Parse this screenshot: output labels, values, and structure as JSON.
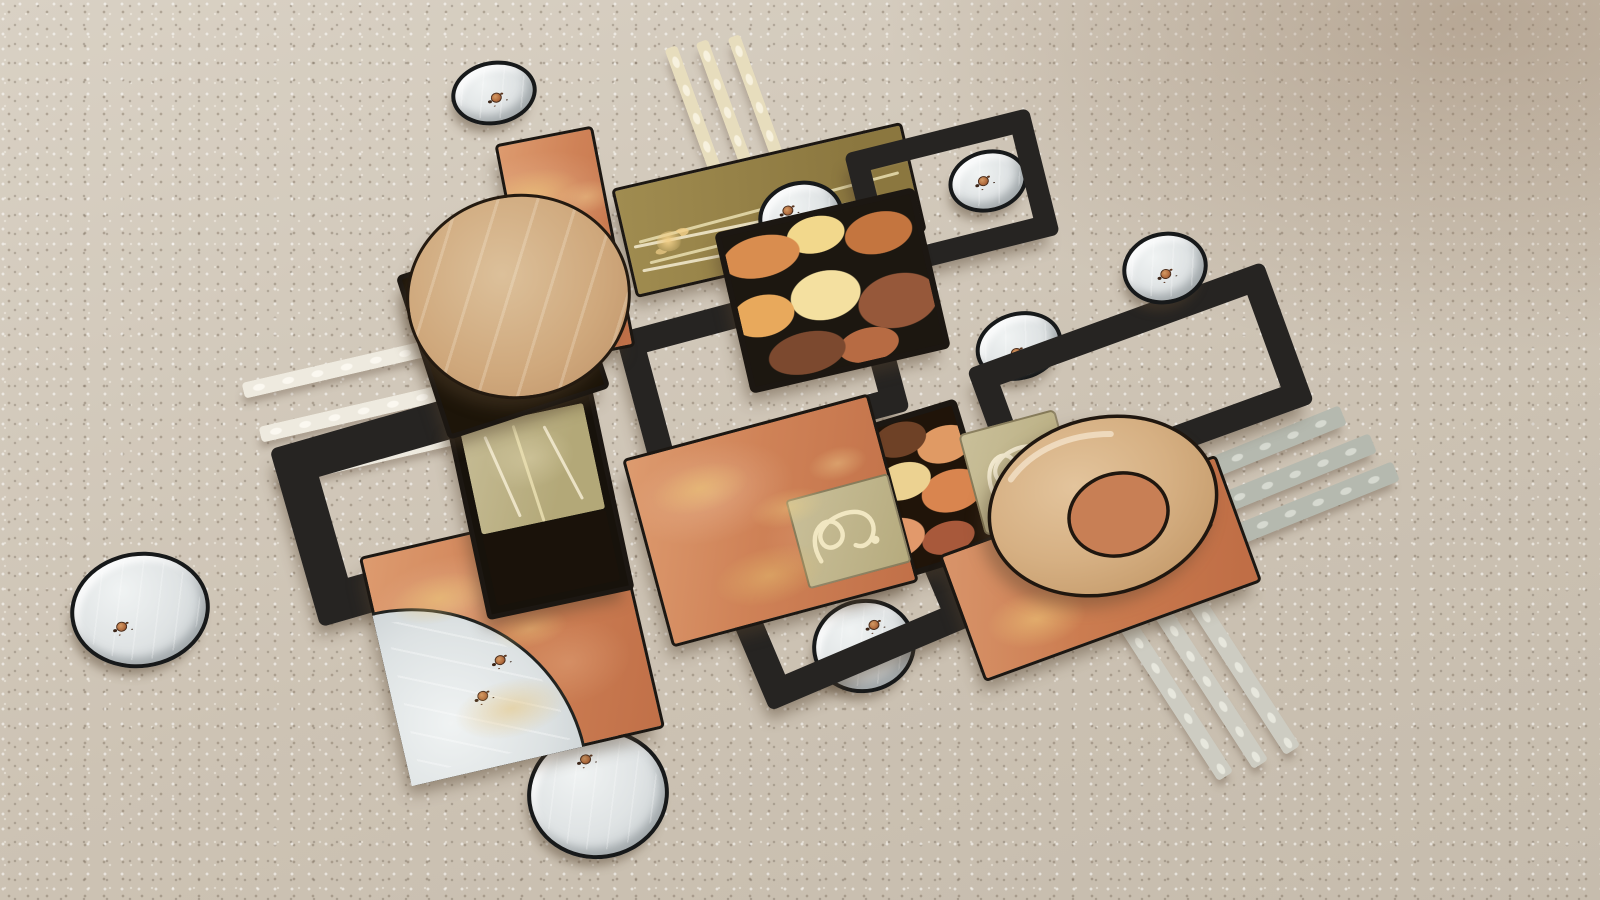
{
  "meta": {
    "image_type": "photograph",
    "subject": "abstract three-piece metal and wood wall-art sculpture laid out on beige carpet",
    "visible_text": "none (only an illegible cursive artist signature on the lower-right orange panel)"
  },
  "palette": {
    "carpet": "#cdc3b4",
    "carpet-light": "#d9d1c4",
    "black": "#262422",
    "edge": "#1c1712",
    "orange": "#d08258",
    "orange-light": "#e0a077",
    "tan": "#d2ad82",
    "olive": "#988447",
    "sand": "#c2b88f",
    "cream": "#efe6c8",
    "silver": "#dfe3e4",
    "silver-deep": "#bfc6c9",
    "copper": "#b06a3c",
    "gold": "#e3bd7d",
    "slat-white": "#eeeadf",
    "slat-cream": "#e7ddbd",
    "slat-gray": "#b5b9af",
    "slat-pale": "#cdccc2",
    "shadow": "rgba(82,64,45,0.45)"
  },
  "art": {
    "silver_discs": 8,
    "black_open_frames": 5,
    "slat_groups": 4,
    "slats_per_group": 3,
    "marbled_panels": 4,
    "orange_panels": 4,
    "tan_ring": 1,
    "tan_circle": 1,
    "silver_quarter_disc": 1,
    "signature_present": true
  }
}
